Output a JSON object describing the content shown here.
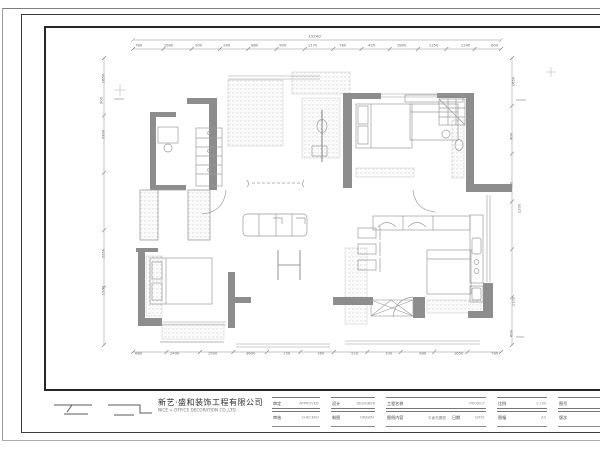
{
  "sheet": {
    "company_cn": "新艺·盛和装饰工程有限公司",
    "company_en": "NICE + OFFICE DECORATION CO.,LTD.",
    "colors": {
      "wall_fill": "#8d8d8d",
      "frame": "#262626",
      "linework": "#9b9b9b",
      "dim_text": "#666666"
    }
  },
  "title_block": {
    "groups": [
      {
        "r1l": "审定",
        "r1s": "APPROVED",
        "r2l": "审核",
        "r2s": "CHECKED"
      },
      {
        "r1l": "设计",
        "r1s": "DESIGNER",
        "r2l": "制图",
        "r2s": "DRAWN"
      },
      {
        "r1l": "工程名称",
        "r1s": "PROJECT",
        "r2l": "图纸内容",
        "r2s": "平面布置图",
        "r3l": "日期",
        "r3s": "DATE"
      },
      {
        "r1l": "比例",
        "r1s": "1:100",
        "r2l": "图幅",
        "r2s": "A3"
      },
      {
        "r1l": "图号",
        "r1s": "NO.",
        "r2l": "版次",
        "r2s": "A0"
      }
    ]
  },
  "dims": {
    "top_total": "15240",
    "top": [
      "780",
      "1600",
      "900",
      "240",
      "880",
      "900",
      "1170",
      "760",
      "420",
      "1800",
      "1150",
      "1240",
      "600"
    ],
    "bottom": [
      "880",
      "2400",
      "1500",
      "3600",
      "150",
      "160",
      "510",
      "100",
      "980",
      "1650",
      "780"
    ],
    "left": [
      "1650",
      "900",
      "3300",
      "2250",
      "1500"
    ],
    "right": [
      "1650",
      "900",
      "450",
      "1200",
      "2100",
      "600"
    ]
  },
  "legend": {
    "symbol1": "break-line-symbol",
    "symbol2": "break-line-symbol"
  }
}
